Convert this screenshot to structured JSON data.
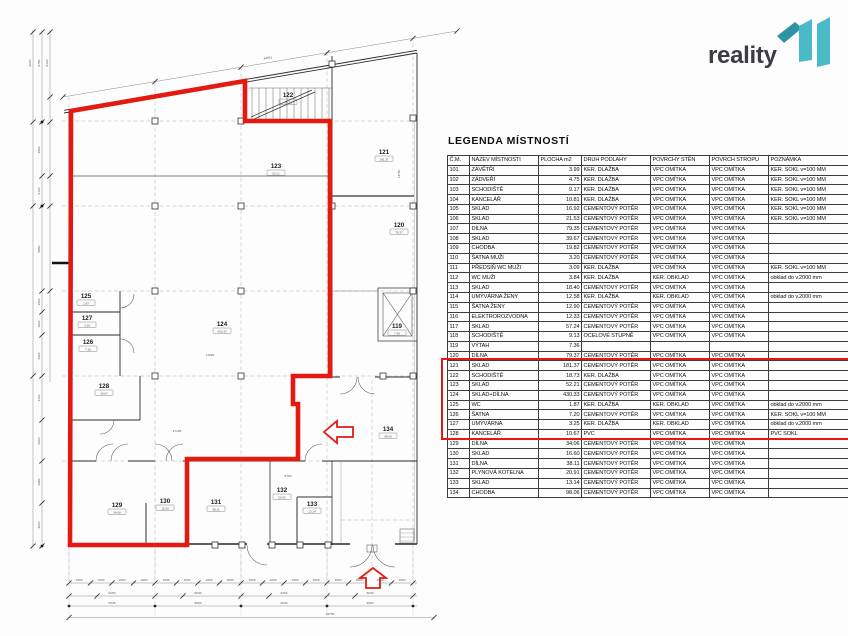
{
  "branding": {
    "logo_text": "reality",
    "logo_mark_name": "11"
  },
  "colors": {
    "highlight_red": "#e41a10",
    "logo_teal": "#4abac8",
    "logo_teal_dark": "#2e93a3",
    "logo_text_color": "#3c3c46"
  },
  "legend": {
    "title": "LEGENDA MÍSTNOSTÍ",
    "columns": [
      "Č.M.",
      "NÁZEV MÍSTNOSTI",
      "PLOCHA m2",
      "DRUH PODLAHY",
      "POVRCHY STĚN",
      "POVRCH STROPU",
      "POZNÁMKA"
    ],
    "rows": [
      [
        "101",
        "ZÁVĚTŘÍ",
        "3.99",
        "KER. DLAŽBA",
        "VPC OMÍTKA",
        "VPC OMÍTKA",
        "KER. SOKL v=100 MM"
      ],
      [
        "102",
        "ZÁDVEŘÍ",
        "4.75",
        "KER. DLAŽBA",
        "VPC OMÍTKA",
        "VPC OMÍTKA",
        "KER. SOKL v=100 MM"
      ],
      [
        "103",
        "SCHODIŠTĚ",
        "9.17",
        "KER. DLAŽBA",
        "VPC OMÍTKA",
        "VPC OMÍTKA",
        "KER. SOKL v=100 MM"
      ],
      [
        "104",
        "KANCELÁŘ",
        "10.81",
        "KER. DLAŽBA",
        "VPC OMÍTKA",
        "VPC OMÍTKA",
        "KER. SOKL v=100 MM"
      ],
      [
        "105",
        "SKLAD",
        "16.92",
        "CEMENTOVÝ POTĚR",
        "VPC OMÍTKA",
        "VPC OMÍTKA",
        "KER. SOKL v=100 MM"
      ],
      [
        "106",
        "SKLAD",
        "21.53",
        "CEMENTOVÝ POTĚR",
        "VPC OMÍTKA",
        "VPC OMÍTKA",
        "KER. SOKL v=100 MM"
      ],
      [
        "107",
        "DÍLNA",
        "79.35",
        "CEMENTOVÝ POTĚR",
        "VPC OMÍTKA",
        "VPC OMÍTKA",
        ""
      ],
      [
        "108",
        "SKLAD",
        "39.67",
        "CEMENTOVÝ POTĚR",
        "VPC OMÍTKA",
        "VPC OMÍTKA",
        ""
      ],
      [
        "109",
        "CHODBA",
        "19.82",
        "CEMENTOVÝ POTĚR",
        "VPC OMÍTKA",
        "VPC OMÍTKA",
        ""
      ],
      [
        "110",
        "ŠATNA MUŽI",
        "3.20",
        "CEMENTOVÝ POTĚR",
        "VPC OMÍTKA",
        "VPC OMÍTKA",
        ""
      ],
      [
        "111",
        "PŘEDSÍŇ WC MUŽI",
        "3.09",
        "KER. DLAŽBA",
        "VPC OMÍTKA",
        "VPC OMÍTKA",
        "KER. SOKL v=100 MM"
      ],
      [
        "112",
        "WC MUŽI",
        "3.84",
        "KER. DLAŽBA",
        "KER. OBKLAD",
        "VPC OMÍTKA",
        "obklad do v.2000 mm"
      ],
      [
        "113",
        "SKLAD",
        "18.40",
        "CEMENTOVÝ POTĚR",
        "VPC OMÍTKA",
        "VPC OMÍTKA",
        ""
      ],
      [
        "114",
        "UMÝVÁRNA ŽENY",
        "12.58",
        "KER. DLAŽBA",
        "KER. OBKLAD",
        "VPC OMÍTKA",
        "obklad do v.2000 mm"
      ],
      [
        "115",
        "ŠATNA ŽENY",
        "12.90",
        "CEMENTOVÝ POTĚR",
        "VPC OMÍTKA",
        "VPC OMÍTKA",
        ""
      ],
      [
        "116",
        "ELEKTROROZVODNA",
        "12.33",
        "CEMENTOVÝ POTĚR",
        "VPC OMÍTKA",
        "VPC OMÍTKA",
        ""
      ],
      [
        "117",
        "SKLAD",
        "57.24",
        "CEMENTOVÝ POTĚR",
        "VPC OMÍTKA",
        "VPC OMÍTKA",
        ""
      ],
      [
        "118",
        "SCHODIŠTĚ",
        "9.13",
        "OCELOVÉ STUPNĚ",
        "VPC OMÍTKA",
        "VPC OMÍTKA",
        ""
      ],
      [
        "119",
        "VÝTAH",
        "7.36",
        "",
        "",
        "",
        ""
      ],
      [
        "120",
        "DÍLNA",
        "79.37",
        "CEMENTOVÝ POTĚR",
        "VPC OMÍTKA",
        "VPC OMÍTKA",
        ""
      ],
      [
        "121",
        "SKLAD",
        "181.37",
        "CEMENTOVÝ POTĚR",
        "VPC OMÍTKA",
        "VPC OMÍTKA",
        ""
      ],
      [
        "122",
        "SCHODIŠTĚ",
        "18.73",
        "KER. DLAŽBA",
        "VPC OMÍTKA",
        "VPC OMÍTKA",
        ""
      ],
      [
        "123",
        "SKLAD",
        "52.21",
        "CEMENTOVÝ POTĚR",
        "VPC OMÍTKA",
        "VPC OMÍTKA",
        ""
      ],
      [
        "124",
        "SKLAD+DÍLNA",
        "430.33",
        "CEMENTOVÝ POTĚR",
        "VPC OMÍTKA",
        "VPC OMÍTKA",
        ""
      ],
      [
        "125",
        "WC",
        "1.87",
        "KER. DLAŽBA",
        "KER. OBKLAD",
        "VPC OMÍTKA",
        "obklad do v.2000 mm"
      ],
      [
        "126",
        "ŠATNA",
        "7.20",
        "CEMENTOVÝ POTĚR",
        "VPC OMÍTKA",
        "VPC OMÍTKA",
        "KER. SOKL v=100 MM"
      ],
      [
        "127",
        "UMÝVÁRNA",
        "3.25",
        "KER. DLAŽBA",
        "KER. OBKLAD",
        "VPC OMÍTKA",
        "obklad do v.2000 mm"
      ],
      [
        "128",
        "KANCELÁŘ",
        "10.67",
        "PVC",
        "VPC OMÍTKA",
        "VPC OMÍTKA",
        "PVC SOKL"
      ],
      [
        "129",
        "DÍLNA",
        "34.06",
        "CEMENTOVÝ POTĚR",
        "VPC OMÍTKA",
        "VPC OMÍTKA",
        ""
      ],
      [
        "130",
        "SKLAD",
        "16.60",
        "CEMENTOVÝ POTĚR",
        "VPC OMÍTKA",
        "VPC OMÍTKA",
        ""
      ],
      [
        "131",
        "DÍLNA",
        "38.11",
        "CEMENTOVÝ POTĚR",
        "VPC OMÍTKA",
        "VPC OMÍTKA",
        ""
      ],
      [
        "132",
        "PLYNOVÁ KOTELNA",
        "20.91",
        "CEMENTOVÝ POTĚR",
        "VPC OMÍTKA",
        "VPC OMÍTKA",
        ""
      ],
      [
        "133",
        "SKLAD",
        "13.14",
        "CEMENTOVÝ POTĚR",
        "VPC OMÍTKA",
        "VPC OMÍTKA",
        ""
      ],
      [
        "134",
        "CHODBA",
        "98.06",
        "CEMENTOVÝ POTĚR",
        "VPC OMÍTKA",
        "VPC OMÍTKA",
        ""
      ]
    ],
    "highlight": {
      "from": "123",
      "to": "130"
    }
  },
  "plan": {
    "rooms": [
      {
        "n": "119",
        "x": 397,
        "y": 328,
        "tag": "7.36"
      },
      {
        "n": "120",
        "x": 399,
        "y": 227,
        "tag": "79.37"
      },
      {
        "n": "121",
        "x": 384,
        "y": 154,
        "tag": "181.37"
      },
      {
        "n": "122",
        "x": 288,
        "y": 97,
        "tag": "18.73"
      },
      {
        "n": "123",
        "x": 276,
        "y": 168,
        "tag": "52.21"
      },
      {
        "n": "124",
        "x": 222,
        "y": 326,
        "tag": "430.33"
      },
      {
        "n": "125",
        "x": 86,
        "y": 298,
        "tag": "1.87"
      },
      {
        "n": "127",
        "x": 87,
        "y": 320,
        "tag": "3.25"
      },
      {
        "n": "126",
        "x": 88,
        "y": 344,
        "tag": "7.20"
      },
      {
        "n": "128",
        "x": 104,
        "y": 388,
        "tag": "10.67"
      },
      {
        "n": "129",
        "x": 117,
        "y": 507,
        "tag": "34.06"
      },
      {
        "n": "130",
        "x": 165,
        "y": 503,
        "tag": "16.60"
      },
      {
        "n": "131",
        "x": 216,
        "y": 504,
        "tag": "38.11"
      },
      {
        "n": "132",
        "x": 282,
        "y": 492,
        "tag": "20.91"
      },
      {
        "n": "133",
        "x": 312,
        "y": 506,
        "tag": "13.14"
      },
      {
        "n": "134",
        "x": 388,
        "y": 431,
        "tag": "98.06"
      }
    ],
    "dim_labels": [
      {
        "t": "44551",
        "x": 268,
        "y": 59,
        "r": -9.5
      },
      {
        "t": "6000",
        "x": 31,
        "y": 63,
        "r": -90
      },
      {
        "t": "6750",
        "x": 40,
        "y": 63,
        "r": -90
      },
      {
        "t": "8100",
        "x": 48,
        "y": 63,
        "r": -90
      },
      {
        "t": "3800",
        "x": 40,
        "y": 150,
        "r": -90
      },
      {
        "t": "2100",
        "x": 40,
        "y": 191,
        "r": -90
      },
      {
        "t": "5950",
        "x": 40,
        "y": 249,
        "r": -90
      },
      {
        "t": "1500",
        "x": 40,
        "y": 302,
        "r": -90
      },
      {
        "t": "1600",
        "x": 40,
        "y": 324,
        "r": -90
      },
      {
        "t": "2900",
        "x": 40,
        "y": 356,
        "r": -90
      },
      {
        "t": "3100",
        "x": 40,
        "y": 398,
        "r": -90
      },
      {
        "t": "2900",
        "x": 40,
        "y": 441,
        "r": -90
      },
      {
        "t": "2950",
        "x": 40,
        "y": 482,
        "r": -90
      },
      {
        "t": "3000",
        "x": 40,
        "y": 525,
        "r": -90
      },
      {
        "t": "1500",
        "x": 79,
        "y": 581,
        "r": 0
      },
      {
        "t": "1600",
        "x": 101,
        "y": 581,
        "r": 0
      },
      {
        "t": "1500",
        "x": 122,
        "y": 581,
        "r": 0
      },
      {
        "t": "1600",
        "x": 144,
        "y": 581,
        "r": 0
      },
      {
        "t": "1500",
        "x": 166,
        "y": 581,
        "r": 0
      },
      {
        "t": "1600",
        "x": 187,
        "y": 581,
        "r": 0
      },
      {
        "t": "1500",
        "x": 209,
        "y": 581,
        "r": 0
      },
      {
        "t": "1600",
        "x": 230,
        "y": 581,
        "r": 0
      },
      {
        "t": "1500",
        "x": 252,
        "y": 581,
        "r": 0
      },
      {
        "t": "1600",
        "x": 273,
        "y": 581,
        "r": 0
      },
      {
        "t": "1500",
        "x": 295,
        "y": 581,
        "r": 0
      },
      {
        "t": "1600",
        "x": 316,
        "y": 581,
        "r": 0
      },
      {
        "t": "1500",
        "x": 338,
        "y": 581,
        "r": 0
      },
      {
        "t": "1600",
        "x": 359,
        "y": 581,
        "r": 0
      },
      {
        "t": "1500",
        "x": 380,
        "y": 581,
        "r": 0
      },
      {
        "t": "1600",
        "x": 402,
        "y": 581,
        "r": 0
      },
      {
        "t": "6250",
        "x": 112,
        "y": 594,
        "r": 0
      },
      {
        "t": "6030",
        "x": 198,
        "y": 594,
        "r": 0
      },
      {
        "t": "6250",
        "x": 284,
        "y": 594,
        "r": 0
      },
      {
        "t": "6030",
        "x": 370,
        "y": 594,
        "r": 0
      },
      {
        "t": "6545",
        "x": 112,
        "y": 604,
        "r": 0
      },
      {
        "t": "9600",
        "x": 198,
        "y": 604,
        "r": 0
      },
      {
        "t": "9630",
        "x": 284,
        "y": 604,
        "r": 0
      },
      {
        "t": "9600",
        "x": 370,
        "y": 604,
        "r": 0
      },
      {
        "t": "44750",
        "x": 330,
        "y": 615,
        "r": 0
      },
      {
        "t": "17195",
        "x": 177,
        "y": 432,
        "r": 0
      },
      {
        "t": "11925",
        "x": 210,
        "y": 356,
        "r": 0
      },
      {
        "t": "5750",
        "x": 288,
        "y": 477,
        "r": 0
      },
      {
        "t": "13750",
        "x": 400,
        "y": 174,
        "r": -90
      }
    ]
  }
}
